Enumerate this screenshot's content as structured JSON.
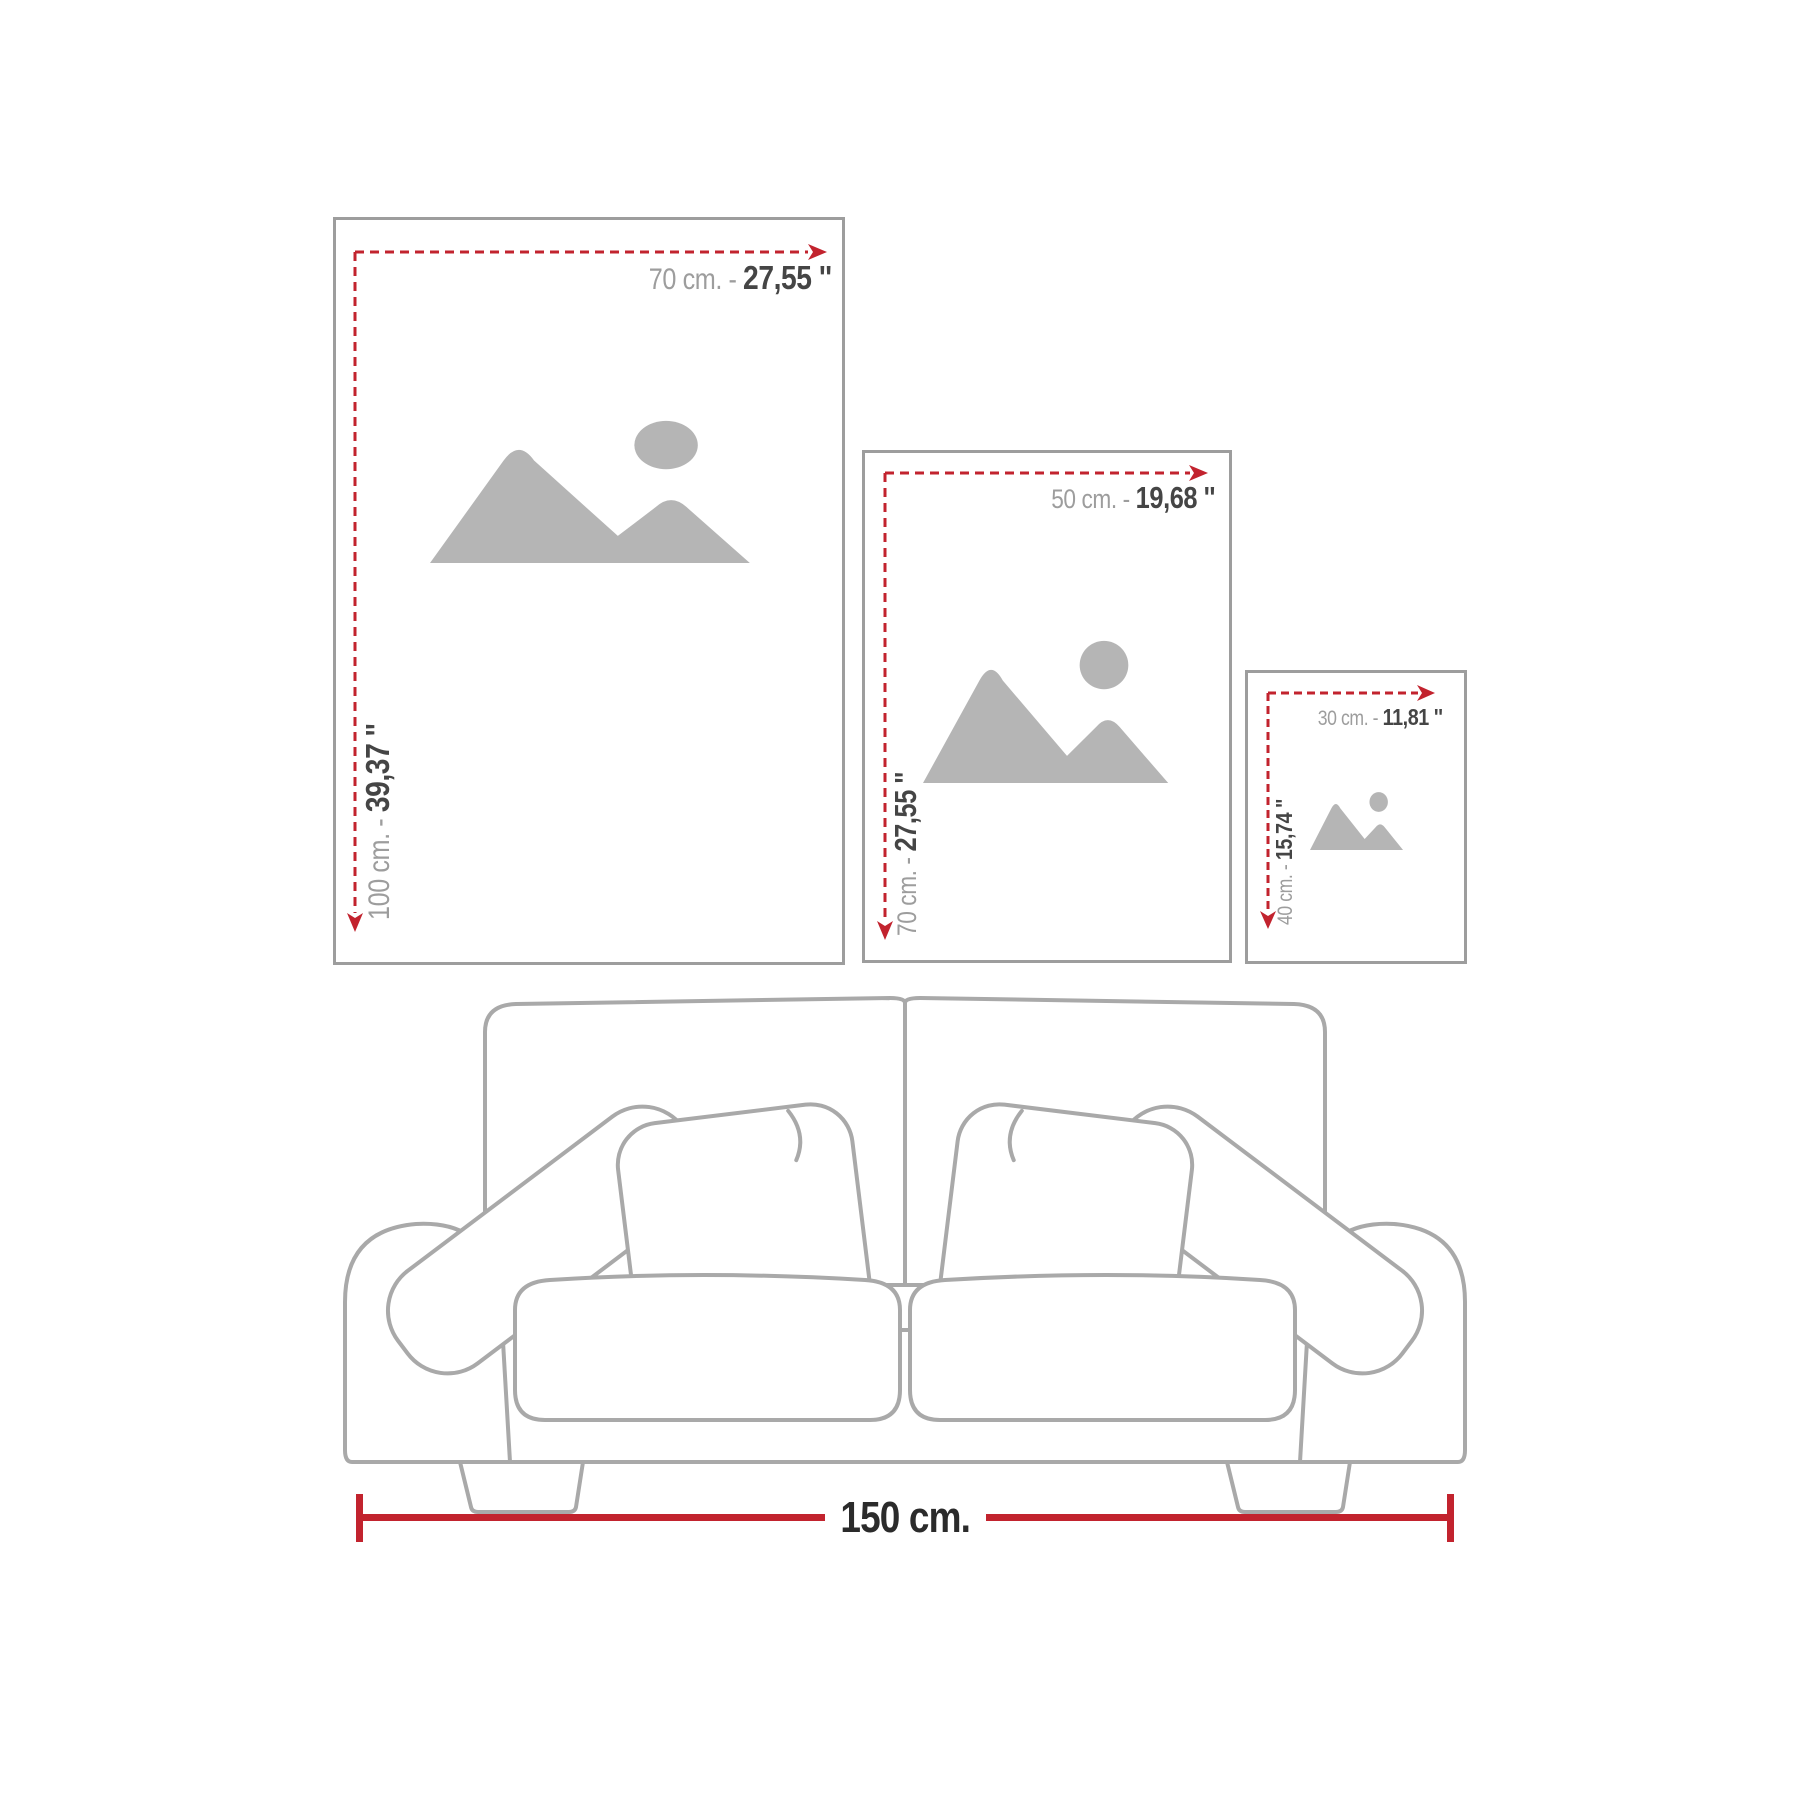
{
  "diagram_title": "poster size guide above sofa",
  "colors": {
    "background": "#ffffff",
    "dimension_red": "#c2232e",
    "frame_border": "#9d9d9d",
    "placeholder_gray": "#b5b5b5",
    "label_gray": "#9d9d9d",
    "label_dark": "#454545",
    "sofa_outline": "#a9a9a9",
    "measure_text": "#2b2b2b"
  },
  "frames": [
    {
      "name": "large-poster",
      "width_cm": "70 cm. -",
      "width_in": "27,55 ''",
      "height_cm": "100 cm. -",
      "height_in": "39,37 ''"
    },
    {
      "name": "medium-poster",
      "width_cm": "50 cm. -",
      "width_in": "19,68 ''",
      "height_cm": "70 cm. -",
      "height_in": "27,55 ''"
    },
    {
      "name": "small-poster",
      "width_cm": "30 cm. -",
      "width_in": "11,81 ''",
      "height_cm": "40 cm. -",
      "height_in": "15,74 ''"
    }
  ],
  "sofa": {
    "width_label": "150 cm."
  }
}
